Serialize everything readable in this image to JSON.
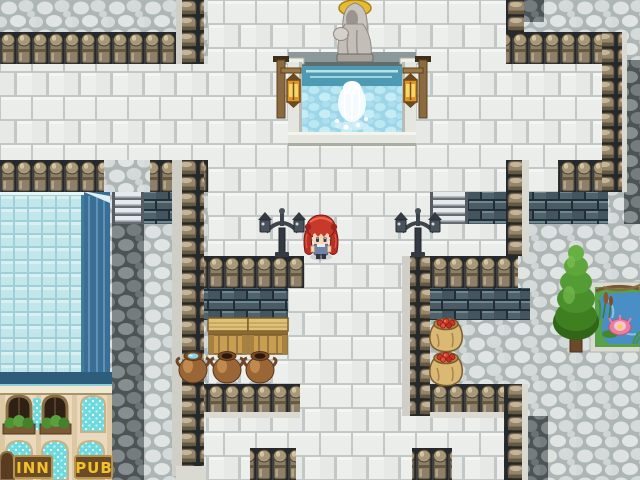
{
  "scene": {
    "game": "rpg-town-plaza",
    "viewport": {
      "width": 640,
      "height": 480
    }
  },
  "signs": {
    "inn": "INN",
    "pub": "PUB"
  },
  "player": {
    "description": "girl with red twin-tail hair and blue dress, facing down"
  },
  "objects": [
    "stone fountain with hooded statue",
    "wooden lantern post left",
    "wooden lantern post right",
    "iron street lamp left",
    "iron street lamp right",
    "wooden crate x2",
    "clay pot x3 (one filled with water)",
    "sack of red apples x2",
    "conifer tree",
    "lily pond",
    "inn and pub building with blue glass roof",
    "battlement stone walls",
    "stair left",
    "stair right"
  ],
  "colors": {
    "cobblestone": "#d5dada",
    "cobblestone_dark": "#5f6668",
    "white_brick": "#eaedea",
    "dark_brick": "#4a5b64",
    "wall_post": "#a99878",
    "roof_glass": "#c2e6ea",
    "roof_edge": "#3a6e94",
    "facade": "#ead9bc",
    "sign_board": "#6b4a26",
    "sign_text": "#f2c22e",
    "fountain_water": "#a6dcec",
    "lantern_glow": "#e09428",
    "tree_green": "#4a8f2c",
    "pond_water": "#4a8ec6",
    "player_hair": "#c63a2c"
  }
}
